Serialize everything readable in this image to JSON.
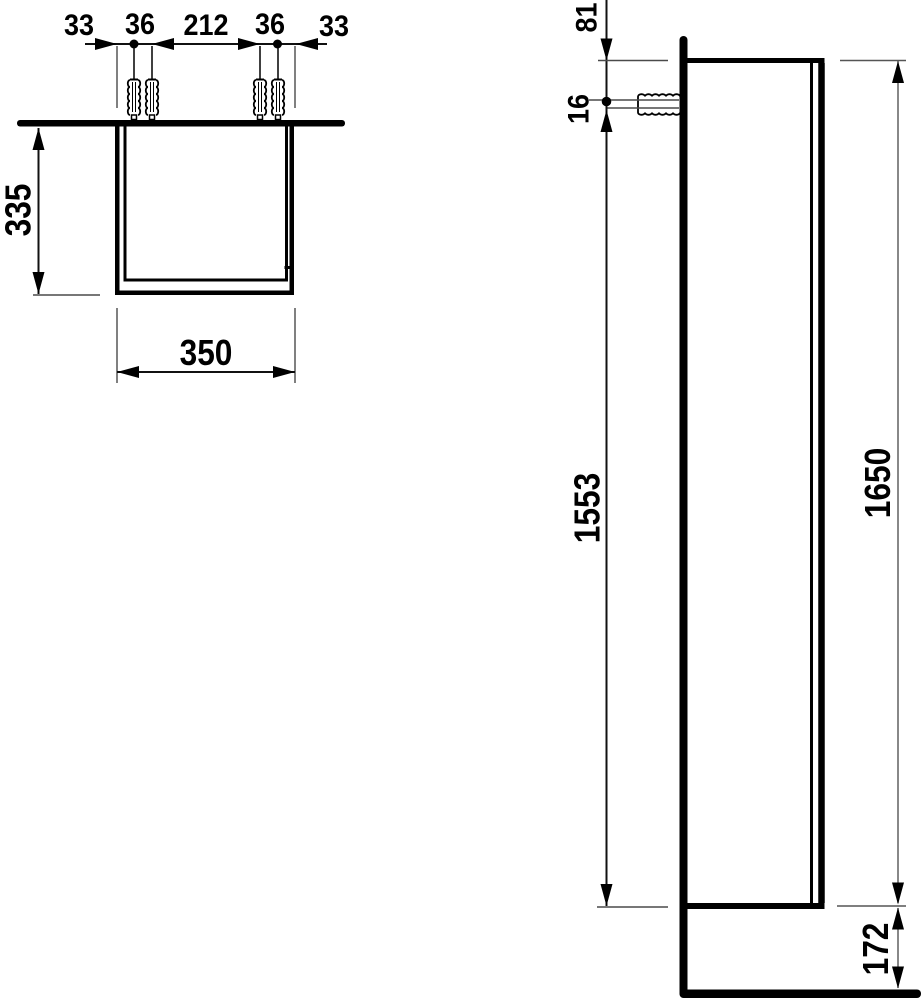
{
  "drawing": {
    "kind": "furniture installation dimension drawing",
    "accent_color": "#000000",
    "background_color": "#ffffff",
    "top_view": {
      "fixing_chain": {
        "left_edge": "33",
        "left_pair": "36",
        "center": "212",
        "right_pair": "36",
        "right_edge": "33"
      },
      "depth": "335",
      "width": "350"
    },
    "side_view": {
      "top_to_fixing": "81",
      "fixing_offset": "16",
      "fixing_to_bottom": "1553",
      "height": "1650",
      "floor_clearance": "172"
    }
  }
}
